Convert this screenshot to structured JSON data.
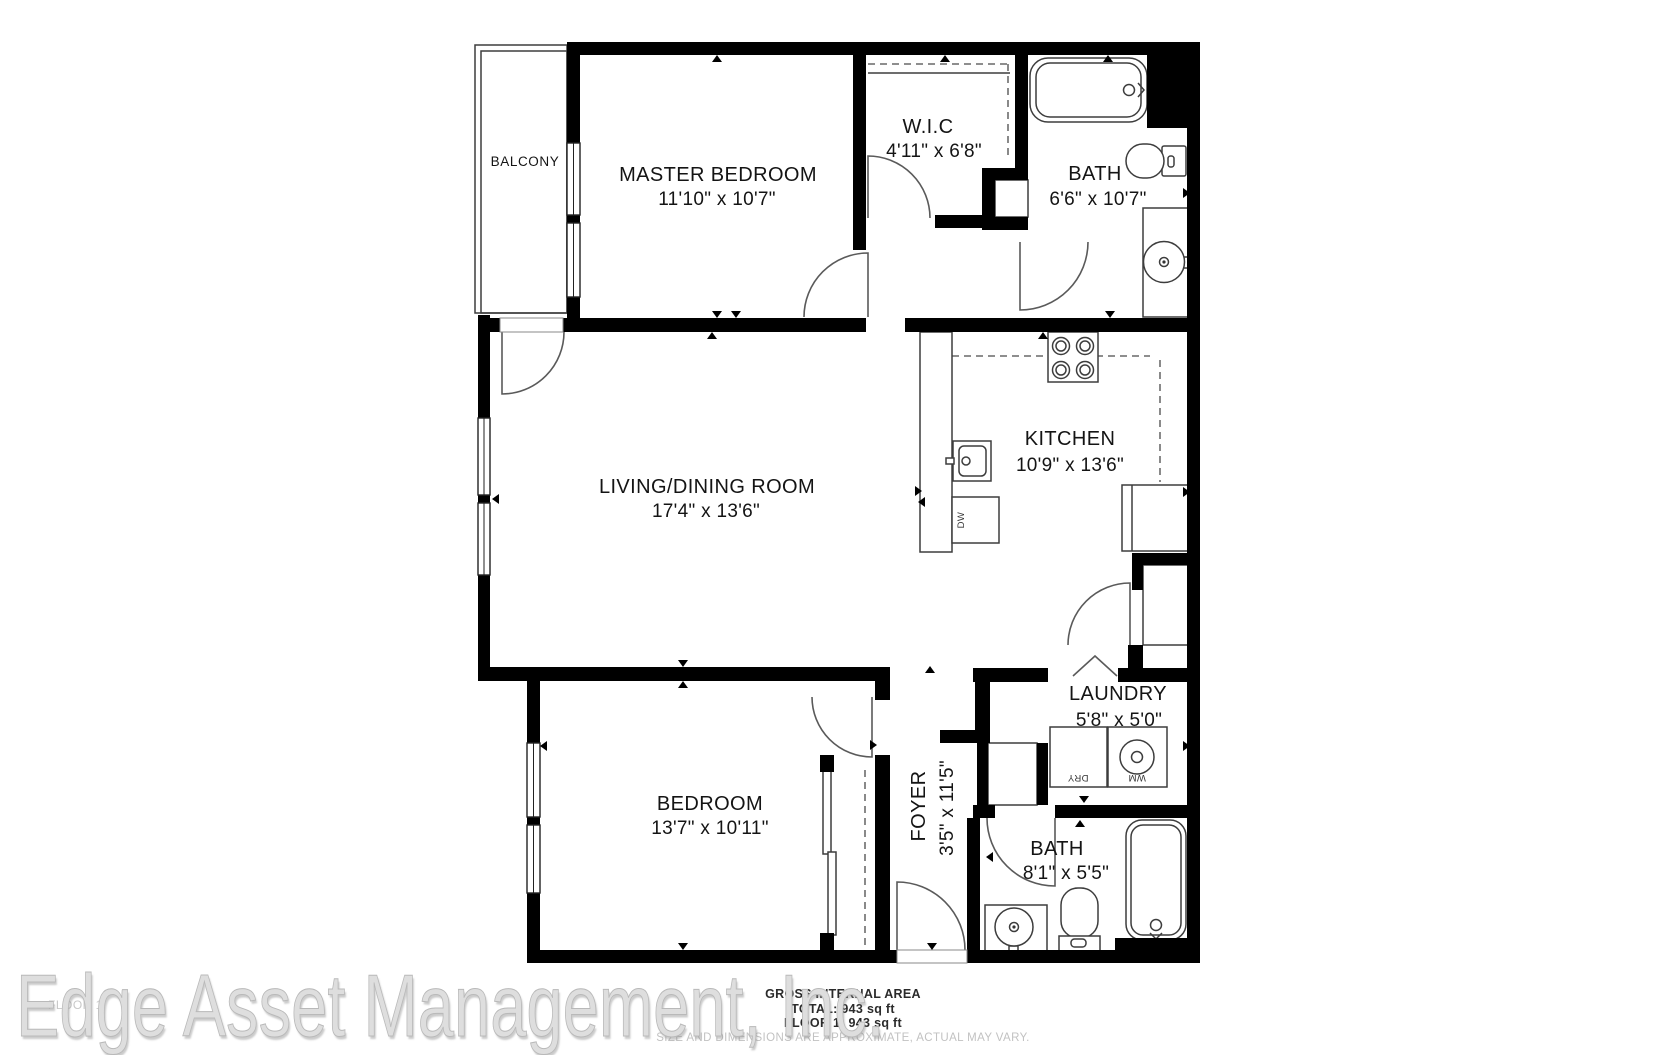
{
  "rooms": {
    "balcony": {
      "name": "BALCONY"
    },
    "master": {
      "name": "MASTER BEDROOM",
      "dims": "11'10\" x 10'7\""
    },
    "wic": {
      "name": "W.I.C",
      "dims": "4'11\" x 6'8\""
    },
    "bath_top": {
      "name": "BATH",
      "dims": "6'6\" x 10'7\""
    },
    "living": {
      "name": "LIVING/DINING ROOM",
      "dims": "17'4\" x 13'6\""
    },
    "kitchen": {
      "name": "KITCHEN",
      "dims": "10'9\" x 13'6\""
    },
    "laundry": {
      "name": "LAUNDRY",
      "dims": "5'8\" x 5'0\""
    },
    "bedroom": {
      "name": "BEDROOM",
      "dims": "13'7\" x 10'11\""
    },
    "foyer": {
      "name": "FOYER",
      "dims": "3'5\" x 11'5\""
    },
    "bath_bottom": {
      "name": "BATH",
      "dims": "8'1\" x 5'5\""
    }
  },
  "appliances": {
    "washer": "WM",
    "dryer": "DRY",
    "dishwasher": "DW"
  },
  "footer": {
    "watermark": "Edge Asset Management, Inc.",
    "floor_tag": "FLOOR 1",
    "area_title": "GROSS INTERNAL AREA",
    "area_total": "TOTAL: 943 sq ft",
    "area_floor1": "FLOOR 1: 943 sq ft",
    "disclaimer": "SIZE AND DIMENSIONS ARE APPROXIMATE, ACTUAL MAY VARY."
  },
  "colors": {
    "wall": "#000000",
    "fixture_line": "#3d3d3d",
    "watermark": "#dedede",
    "muted_text": "#c2c2c2"
  }
}
